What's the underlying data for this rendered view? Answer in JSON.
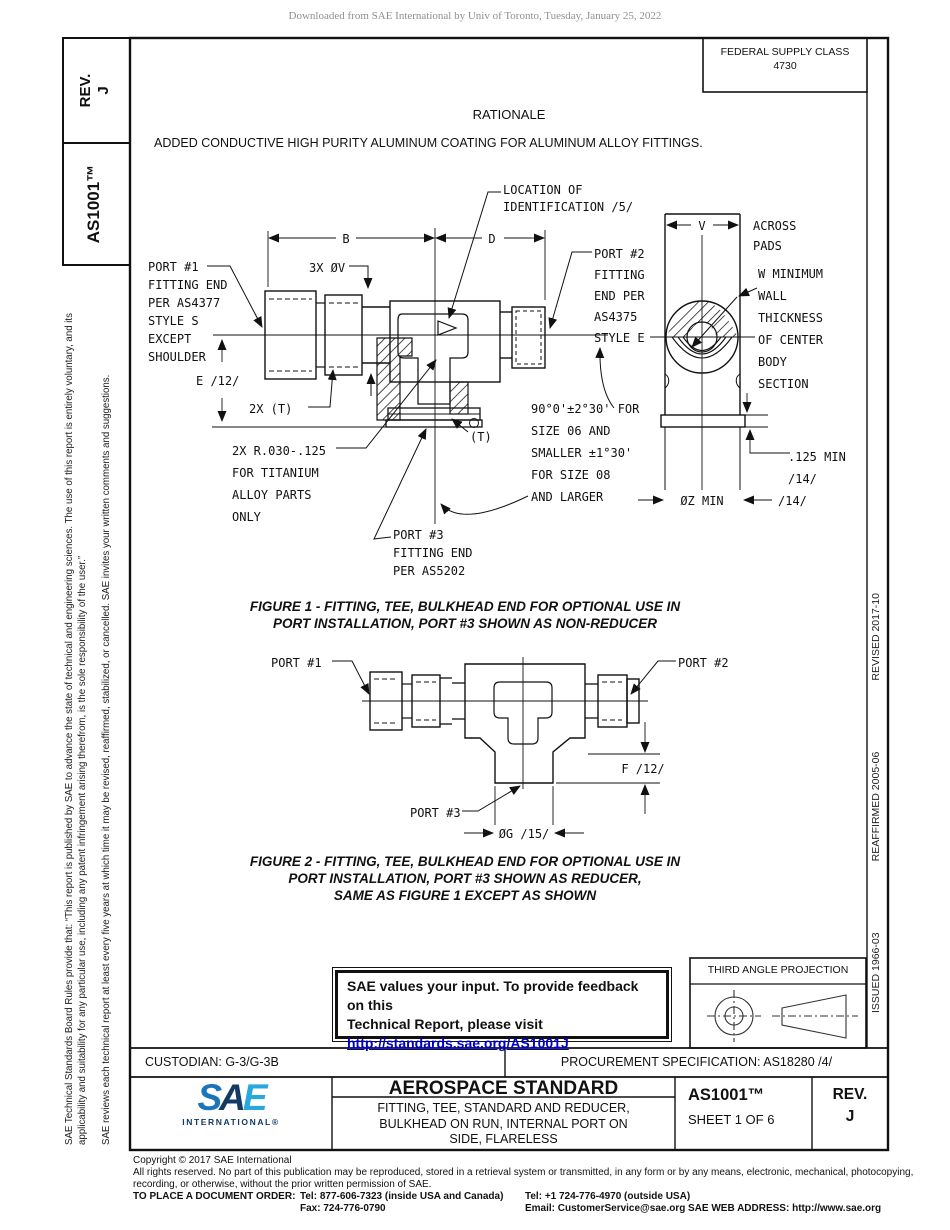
{
  "colors": {
    "line": "#111111",
    "link_blue": "#0000cd",
    "logo_navy": "#123a63",
    "logo_blue": "#1b75bb",
    "logo_light": "#29a8df",
    "watermark_gray": "#8f8f8d"
  },
  "watermark": "Downloaded from SAE International by Univ of Toronto, Tuesday, January 25, 2022",
  "left_sidebar": {
    "rev_label": "REV.",
    "rev_value": "J",
    "doc_number": "AS1001™",
    "legal_para1": "SAE Technical Standards Board Rules provide that: “This report is published by SAE to advance the state of technical and engineering sciences. The use of this report is entirely voluntary, and its applicability and suitability for any particular use, including any patent infringement arising therefrom, is the sole responsibility of the user.”",
    "legal_para2": "SAE reviews each technical report at least every five years at which time it may be revised, reaffirmed, stabilized, or cancelled. SAE invites your written comments and suggestions."
  },
  "right_sidebar": {
    "issued": "ISSUED 1966-03",
    "reaffirmed": "REAFFIRMED 2005-06",
    "revised": "REVISED 2017-10"
  },
  "header": {
    "fsc_label": "FEDERAL SUPPLY CLASS",
    "fsc_value": "4730",
    "rationale_title": "RATIONALE",
    "rationale_text": "ADDED CONDUCTIVE HIGH PURITY ALUMINUM COATING FOR ALUMINUM ALLOY FITTINGS."
  },
  "figure1": {
    "labels": {
      "location_id": "LOCATION OF\nIDENTIFICATION /5/",
      "port1": "PORT #1\nFITTING END\nPER AS4377\nSTYLE S\nEXCEPT\nSHOULDER",
      "thread_count": "3X ØV",
      "dim_b": "B",
      "dim_d": "D",
      "port2": "PORT #2\nFITTING\nEND PER\nAS4375\nSTYLE E",
      "dim_v": "V",
      "across_pads": "ACROSS\nPADS",
      "wall_note": "W MINIMUM\nWALL\nTHICKNESS\nOF CENTER\nBODY\nSECTION",
      "dim_e": "E /12/",
      "thread_t": "2X (T)",
      "angle_note": "90°0'±2°30' FOR\nSIZE 06 AND\nSMALLER ±1°30'\nFOR SIZE 08\nAND LARGER",
      "radius_note": "2X R.030-.125\nFOR TITANIUM\nALLOY PARTS\nONLY",
      "t_ref": "(T)",
      "min_125": ".125 MIN\n/14/",
      "port3": "PORT #3\nFITTING END\nPER AS5202",
      "dim_z": "ØZ MIN",
      "ref_14": "/14/"
    },
    "caption": "FIGURE 1 - FITTING, TEE, BULKHEAD END FOR OPTIONAL USE IN\nPORT INSTALLATION, PORT #3 SHOWN AS NON-REDUCER"
  },
  "figure2": {
    "labels": {
      "port1": "PORT #1",
      "port2": "PORT #2",
      "port3": "PORT #3",
      "dim_f": "F /12/",
      "dim_g": "ØG /15/"
    },
    "caption": "FIGURE 2 - FITTING, TEE, BULKHEAD END FOR OPTIONAL USE IN\nPORT INSTALLATION, PORT #3 SHOWN AS REDUCER,\nSAME AS FIGURE 1 EXCEPT AS SHOWN"
  },
  "feedback_box": {
    "line1": "SAE values your input. To provide feedback on this",
    "line2": "Technical Report, please visit",
    "link": "http://standards.sae.org/AS1001J"
  },
  "projection_box": {
    "title": "THIRD ANGLE PROJECTION"
  },
  "title_block": {
    "custodian": "CUSTODIAN: G-3/G-3B",
    "procurement": "PROCUREMENT SPECIFICATION: AS18280 /4/",
    "logo_s": "S",
    "logo_a": "A",
    "logo_e": "E",
    "logo_sub": "INTERNATIONAL®",
    "title": "AEROSPACE STANDARD",
    "subtitle": "FITTING, TEE, STANDARD AND REDUCER,\nBULKHEAD ON RUN, INTERNAL PORT ON\nSIDE, FLARELESS",
    "doc_number": "AS1001™",
    "sheet": "SHEET 1 OF 6",
    "rev_label": "REV.",
    "rev_value": "J"
  },
  "footer": {
    "copyright": "Copyright © 2017 SAE International",
    "rights_line1": "All rights reserved. No part of this publication may be reproduced, stored in a retrieval system or transmitted, in any form or by any means, electronic, mechanical, photocopying,",
    "rights_line2": "recording, or otherwise, without the prior written permission of SAE.",
    "order_label": "TO PLACE A DOCUMENT ORDER:",
    "order_tel1": "Tel: 877-606-7323 (inside USA and Canada)",
    "order_tel2": "Tel: +1 724-776-4970 (outside USA)",
    "order_fax": "Fax: 724-776-0790",
    "order_email": "Email: CustomerService@sae.org",
    "web": "SAE WEB ADDRESS: http://www.sae.org"
  }
}
